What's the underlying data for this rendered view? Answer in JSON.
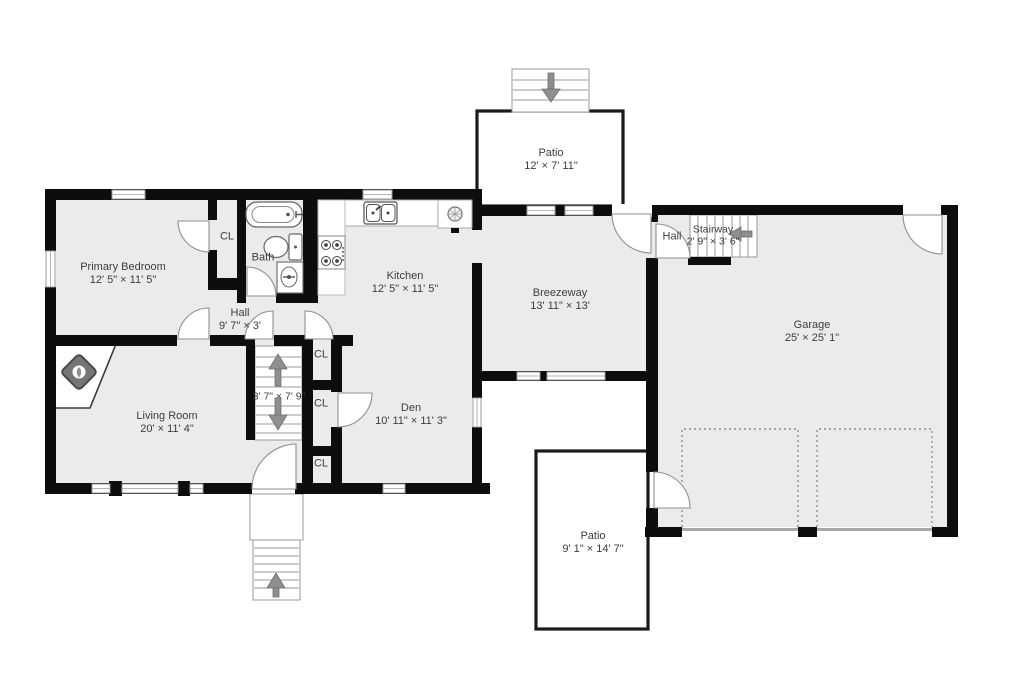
{
  "floor_plan": {
    "rooms": {
      "primary_bedroom": {
        "name": "Primary Bedroom",
        "dims": "12' 5\" × 11' 5\""
      },
      "bath": {
        "name": "Bath"
      },
      "kitchen": {
        "name": "Kitchen",
        "dims": "12' 5\" × 11' 5\""
      },
      "hall": {
        "name": "Hall",
        "dims": "9' 7\" × 3'"
      },
      "living_room": {
        "name": "Living Room",
        "dims": "20' × 11' 4\""
      },
      "den": {
        "name": "Den",
        "dims": "10' 11\" × 11' 3\""
      },
      "breezeway": {
        "name": "Breezeway",
        "dims": "13' 11\" × 13'"
      },
      "garage": {
        "name": "Garage",
        "dims": "25' × 25' 1\""
      },
      "patio_upper": {
        "name": "Patio",
        "dims": "12' × 7' 11\""
      },
      "patio_lower": {
        "name": "Patio",
        "dims": "9' 1\" × 14' 7\""
      },
      "stairway": {
        "name": "Stairway",
        "dims": "2' 9\" × 3' 6\""
      },
      "upper_hall": {
        "name": "Hall"
      },
      "center_stairs": {
        "dims": "3' 7\" × 7' 9\""
      }
    },
    "closet_label": "CL",
    "colors": {
      "wall": "#0d0d0d",
      "floor": "#ebebeb",
      "line": "#909090",
      "arrow": "#8f8f8f"
    }
  }
}
